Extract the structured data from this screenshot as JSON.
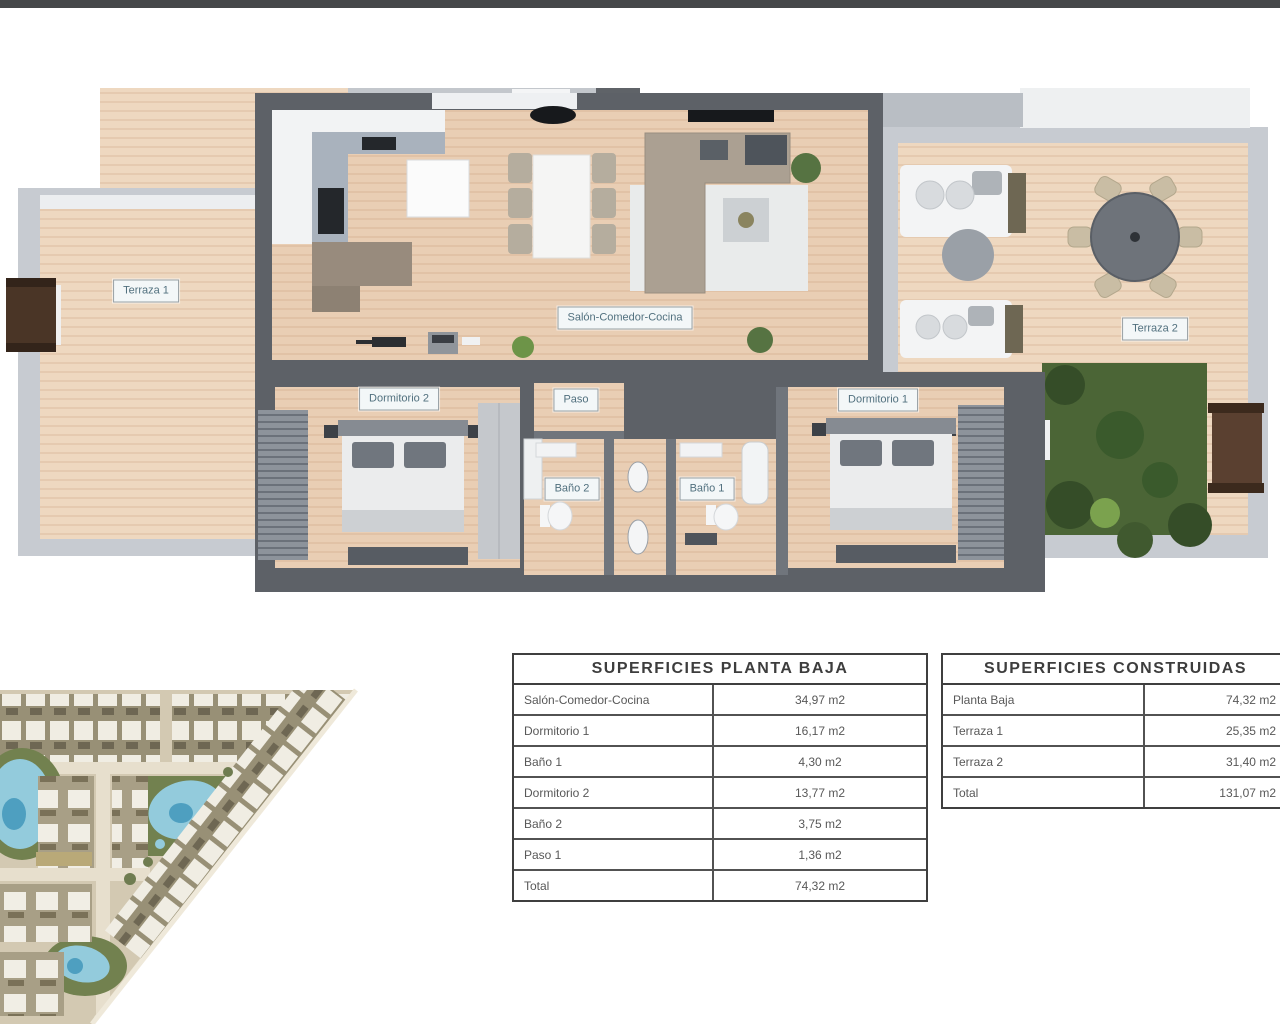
{
  "floor_plan": {
    "labels": [
      {
        "id": "terraza1",
        "text": "Terraza 1"
      },
      {
        "id": "salon",
        "text": "Salón-Comedor-Cocina"
      },
      {
        "id": "terraza2",
        "text": "Terraza 2"
      },
      {
        "id": "dormitorio2",
        "text": "Dormitorio 2"
      },
      {
        "id": "paso",
        "text": "Paso"
      },
      {
        "id": "dormitorio1",
        "text": "Dormitorio 1"
      },
      {
        "id": "bano2",
        "text": "Baño 2"
      },
      {
        "id": "bano1",
        "text": "Baño 1"
      }
    ],
    "colors": {
      "wood_floor": "#e9ceb4",
      "terrace_wood": "#eed8c0",
      "wall_dark": "#5d6167",
      "wall_light": "#c7cbd1",
      "furniture_white": "#f2f3f4",
      "sofa_taupe": "#aba092",
      "grass_green": "#4b6536",
      "door_brown": "#4a3526"
    }
  },
  "site_plan": {
    "colors": {
      "ground": "#d3c9b2",
      "road": "#e7dfcd",
      "pool_blue": "#93cbdc",
      "pool_deep": "#4e9fc0",
      "green": "#72814f",
      "roof_white": "#f0ede3"
    }
  },
  "tables": {
    "planta_baja": {
      "title": "SUPERFICIES PLANTA BAJA",
      "rows": [
        {
          "label": "Salón-Comedor-Cocina",
          "value": "34,97 m2"
        },
        {
          "label": "Dormitorio 1",
          "value": "16,17 m2"
        },
        {
          "label": "Baño 1",
          "value": "4,30 m2"
        },
        {
          "label": "Dormitorio 2",
          "value": "13,77 m2"
        },
        {
          "label": "Baño 2",
          "value": "3,75 m2"
        },
        {
          "label": "Paso 1",
          "value": "1,36 m2"
        },
        {
          "label": "Total",
          "value": "74,32 m2"
        }
      ]
    },
    "construidas": {
      "title": "SUPERFICIES CONSTRUIDAS",
      "rows": [
        {
          "label": "Planta Baja",
          "value": "74,32 m2"
        },
        {
          "label": "Terraza 1",
          "value": "25,35 m2"
        },
        {
          "label": "Terraza 2",
          "value": "31,40 m2"
        },
        {
          "label": "Total",
          "value": "131,07 m2"
        }
      ]
    }
  }
}
